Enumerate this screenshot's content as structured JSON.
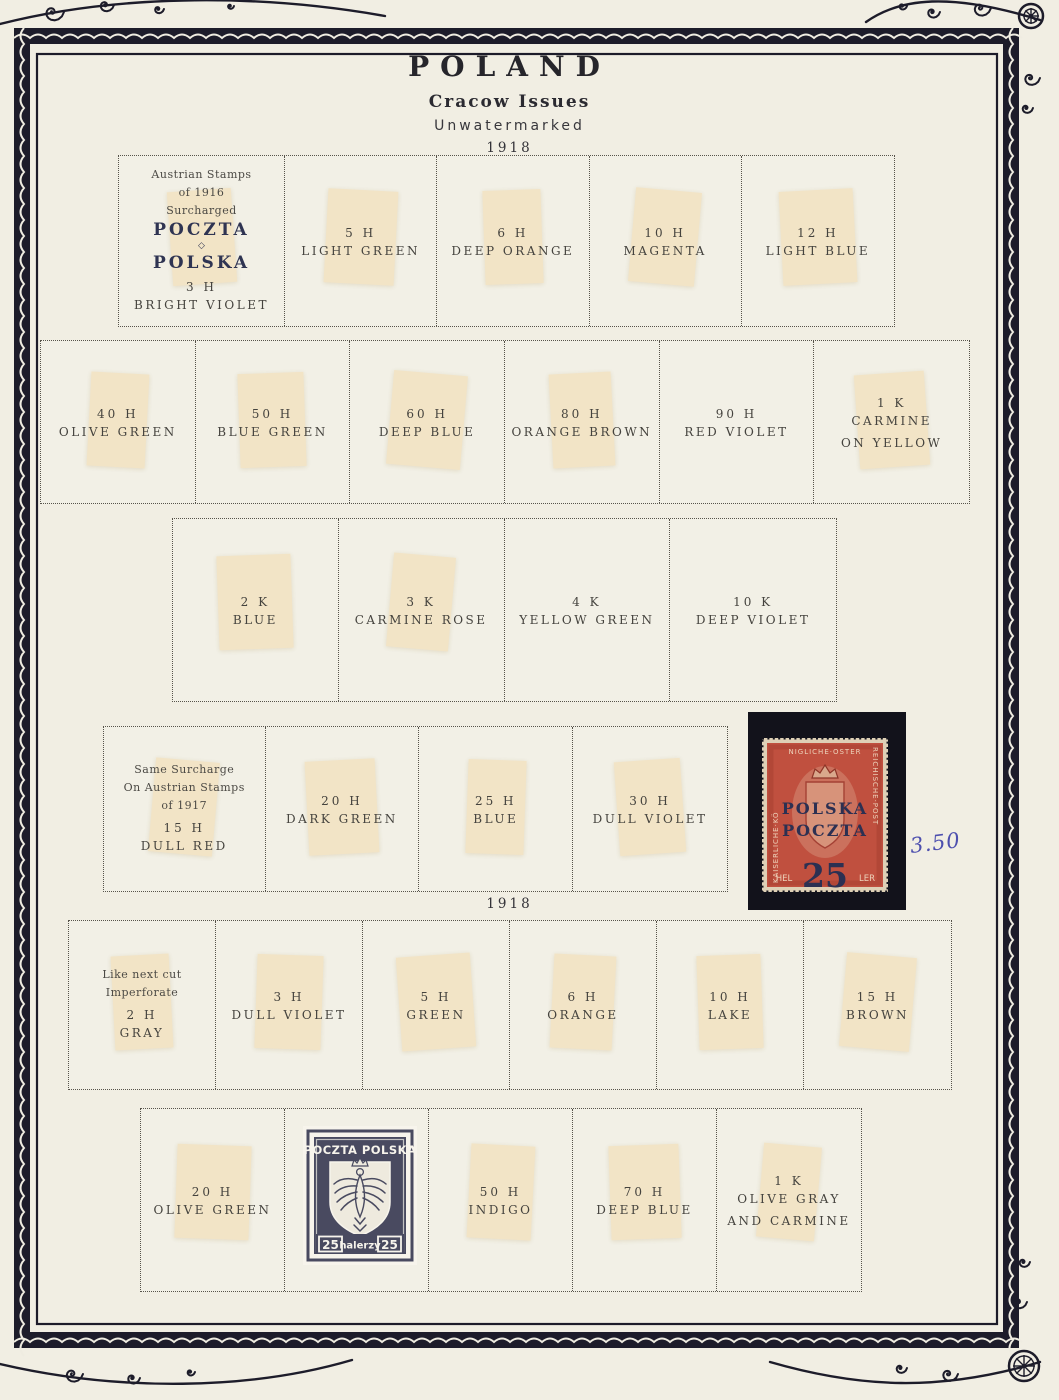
{
  "page": {
    "title": "POLAND",
    "subtitle": "Cracow Issues",
    "watermark_note": "Unwatermarked",
    "year_top": "1918",
    "year_mid": "1918",
    "handwritten_price": "3.50"
  },
  "colors": {
    "page_background": "#f1eee3",
    "frame_ink": "#1d1c2a",
    "text_ink": "#45433e",
    "overprint_ink": "#2f3452",
    "hinge": "#f3e3c3",
    "stamp_red": "#c0503f",
    "stamp_navy": "#30324a",
    "handwriting_blue": "#4d4fae"
  },
  "boxes": [
    {
      "cells": [
        {
          "note": [
            "Austrian Stamps",
            "of 1916",
            "Surcharged"
          ],
          "overprint": {
            "top": "POCZTA",
            "divider": "◇",
            "bottom": "POLSKA"
          },
          "denom": "3 H",
          "color": [
            "BRIGHT VIOLET"
          ],
          "hinge": true
        },
        {
          "denom": "5 H",
          "color": [
            "LIGHT GREEN"
          ],
          "hinge": true
        },
        {
          "denom": "6 H",
          "color": [
            "DEEP ORANGE"
          ],
          "hinge": true
        },
        {
          "denom": "10 H",
          "color": [
            "MAGENTA"
          ],
          "hinge": true
        },
        {
          "denom": "12 H",
          "color": [
            "LIGHT BLUE"
          ],
          "hinge": true
        }
      ]
    },
    {
      "cells": [
        {
          "denom": "40 H",
          "color": [
            "OLIVE GREEN"
          ],
          "hinge": true
        },
        {
          "denom": "50 H",
          "color": [
            "BLUE GREEN"
          ],
          "hinge": true
        },
        {
          "denom": "60 H",
          "color": [
            "DEEP BLUE"
          ],
          "hinge": true
        },
        {
          "denom": "80 H",
          "color": [
            "ORANGE BROWN"
          ],
          "hinge": true
        },
        {
          "denom": "90 H",
          "color": [
            "RED VIOLET"
          ],
          "hinge": false
        },
        {
          "denom": "1 K",
          "color": [
            "CARMINE",
            "ON YELLOW"
          ],
          "hinge": true
        }
      ]
    },
    {
      "cells": [
        {
          "denom": "2 K",
          "color": [
            "BLUE"
          ],
          "hinge": true
        },
        {
          "denom": "3 K",
          "color": [
            "CARMINE ROSE"
          ],
          "hinge": true
        },
        {
          "denom": "4 K",
          "color": [
            "YELLOW GREEN"
          ],
          "hinge": false
        },
        {
          "denom": "10 K",
          "color": [
            "DEEP VIOLET"
          ],
          "hinge": false
        }
      ]
    },
    {
      "cells": [
        {
          "note": [
            "Same Surcharge",
            "On Austrian Stamps",
            "of 1917"
          ],
          "denom": "15 H",
          "color": [
            "DULL RED"
          ],
          "hinge": true
        },
        {
          "denom": "20 H",
          "color": [
            "DARK GREEN"
          ],
          "hinge": true
        },
        {
          "denom": "25 H",
          "color": [
            "BLUE"
          ],
          "hinge": true
        },
        {
          "denom": "30 H",
          "color": [
            "DULL VIOLET"
          ],
          "hinge": true
        }
      ]
    },
    {
      "cells": [
        {
          "note": [
            "Like next cut",
            "Imperforate"
          ],
          "denom": "2 H",
          "color": [
            "GRAY"
          ],
          "hinge": true
        },
        {
          "denom": "3 H",
          "color": [
            "DULL VIOLET"
          ],
          "hinge": true
        },
        {
          "denom": "5 H",
          "color": [
            "GREEN"
          ],
          "hinge": true
        },
        {
          "denom": "6 H",
          "color": [
            "ORANGE"
          ],
          "hinge": true
        },
        {
          "denom": "10 H",
          "color": [
            "LAKE"
          ],
          "hinge": true
        },
        {
          "denom": "15 H",
          "color": [
            "BROWN"
          ],
          "hinge": true
        }
      ]
    },
    {
      "cells": [
        {
          "denom": "20 H",
          "color": [
            "OLIVE GREEN"
          ],
          "hinge": true
        },
        {
          "stamp_cut": true,
          "hinge": false
        },
        {
          "denom": "50 H",
          "color": [
            "INDIGO"
          ],
          "hinge": true
        },
        {
          "denom": "70 H",
          "color": [
            "DEEP BLUE"
          ],
          "hinge": true
        },
        {
          "denom": "1 K",
          "color": [
            "OLIVE GRAY",
            "AND CARMINE"
          ],
          "hinge": true
        }
      ]
    }
  ],
  "stamp_mounted": {
    "frame_left": "KAISERLICHE·KÖ",
    "frame_top": "NIGLICHE·OSTER",
    "frame_right": "REICHISCHE·POST",
    "bottom_left": "HEL",
    "bottom_right": "LER",
    "overprint_line1": "POLSKA",
    "overprint_line2": "POCZTA",
    "overprint_value": "25"
  },
  "stamp_cut": {
    "header": "POCZTA POLSKA",
    "value_left": "25",
    "value_label": "halerzy",
    "value_right": "25"
  }
}
